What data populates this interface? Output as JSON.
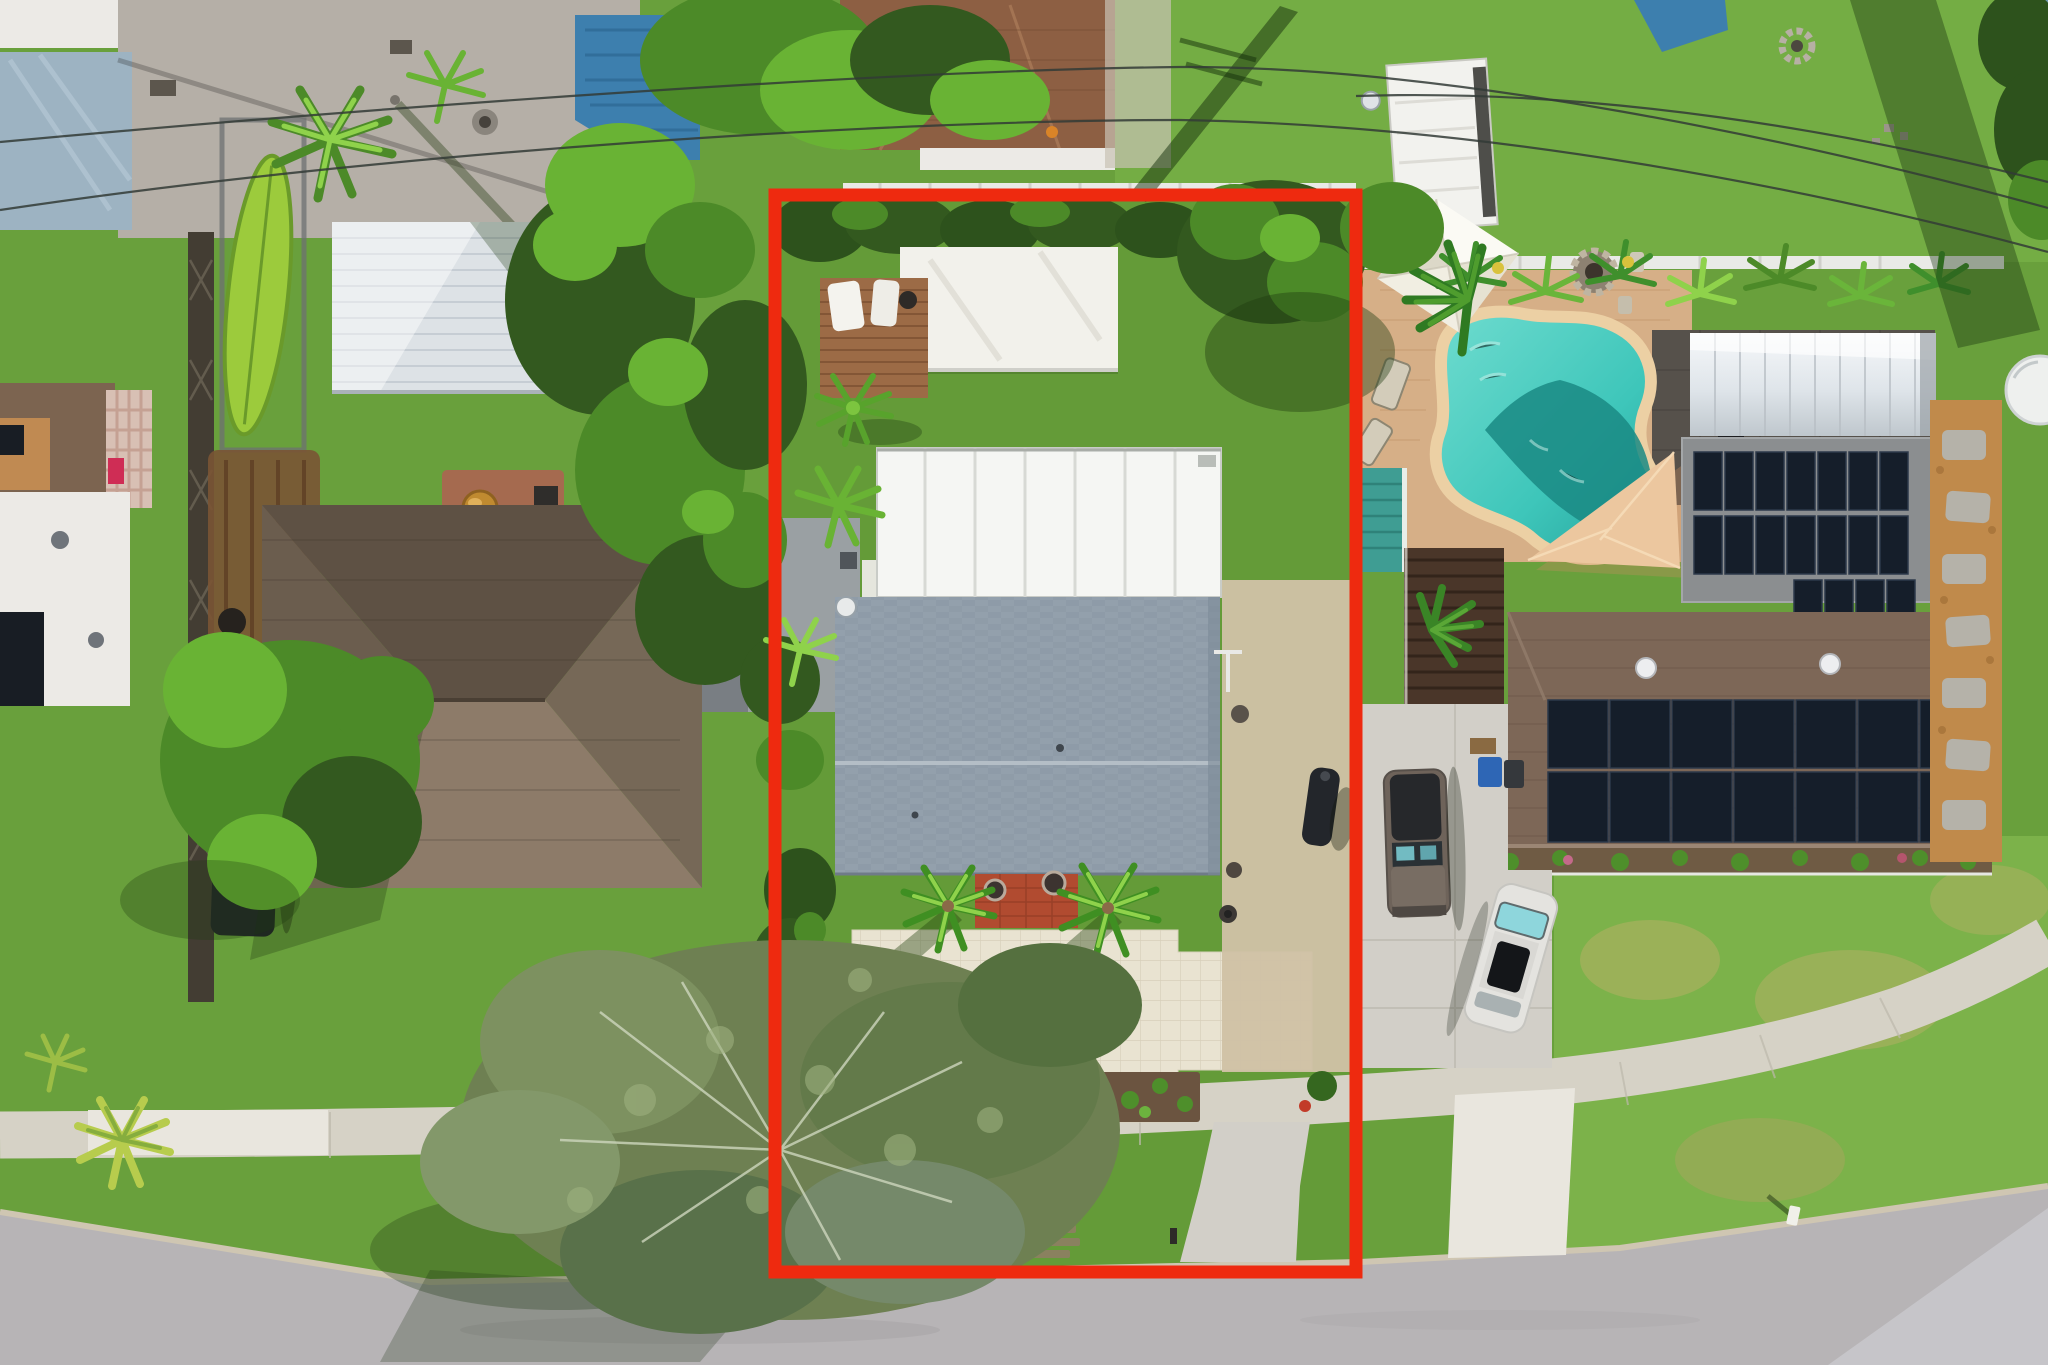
{
  "title": "Aerial drone photo of a residential neighborhood with one lot outlined in red",
  "canvas": {
    "width": 2048,
    "height": 1365
  },
  "annotation": {
    "label": "property-boundary-outline",
    "x": 775,
    "y": 195,
    "width": 581,
    "height": 1077,
    "stroke_width": 13,
    "color": "#ee2a0f"
  },
  "colors": {
    "grass_base": "#69a03c",
    "grass_lot": "#649b38",
    "grass_back": "#74ad44",
    "grass_front_r": "#7cb24a",
    "road": "#b7b4b6",
    "road_gutter": "#c6c5c9",
    "curb": "#cfc6b2",
    "sidewalk": "#d6d2c6",
    "concrete": "#d2cfc8",
    "concrete_bright": "#e9e6de",
    "paver_cream": "#e9e3d1",
    "paver_line": "#d8d0bb",
    "shed_white": "#f2f1eb",
    "carport_white": "#f5f6f3",
    "carport_seam": "#d7d9d4",
    "roof_gray": "#93a0ac",
    "roof_gray_line": "#8a97a3",
    "roof_ridge": "#b4bec6",
    "deck_brown": "#9c6b46",
    "porch_brick": "#b14b30",
    "gravel_tan": "#cfc2a5",
    "pool_deck_tan": "#d6af87",
    "patio_dark": "#56514b",
    "pool_water": "#3ec6ba",
    "pool_deep": "#1a8a84",
    "pool_coping": "#ecd0a4",
    "canopy_white": "#f7f5ee",
    "sail_peach": "#ecc79f",
    "solar_panel": "#151e2a",
    "solar_panel_edge": "#2c394a",
    "roof_brown_right": "#7d6757",
    "roof_brown_left_top": "#5e5144",
    "roof_brown_left_lit": "#8d7b69",
    "annex_gray": "#9aa0a3",
    "silver_metal": "#dde2e6",
    "blue_roof": "#3d7fae",
    "blue_slab": "#9db3c2",
    "teal_roof": "#3f9d93",
    "pergola_brown": "#4a3629",
    "mulch_orange": "#c08a4b",
    "mulch_bed": "#6b5440",
    "suv_taupe": "#6e635a",
    "car_white": "#e4e3df",
    "truck_black": "#212529",
    "kayak_green": "#9ccb3c",
    "trailer_rust": "#7a5434",
    "gold_bowl": "#c08a30",
    "fence_white": "#e9eae6",
    "tree_dark": "#33591f",
    "tree_mid": "#4c8a28",
    "tree_bright": "#69b334",
    "tree_gray": "#6e8052",
    "hedge_dark": "#2d521c",
    "shadow_green": "#15300c",
    "powerline": "#333b36",
    "white_structure": "#eceae6",
    "red_outline": "#ee2a0f"
  },
  "scene": {
    "subject_lot": {
      "label": "outlined listing property",
      "features": [
        "back lawn",
        "white flat-roof shed",
        "wood deck with two white loungers",
        "white metal carport",
        "gray shingle roof house with satellite dish",
        "red brick porch with two round planters",
        "cream paver courtyard driveway",
        "two royal palms",
        "two mulch planting beds",
        "tan gravel side yard",
        "wood stepping-stone path in verge",
        "concrete apron to street"
      ]
    },
    "left_property": {
      "features": [
        "brown hip-roof house",
        "gray flat annex",
        "silver corrugated shed",
        "green kayak on rack",
        "rusted utility trailer",
        "brick bbq with gold fire bowl",
        "black pickup truck",
        "large leafy tree",
        "huge gray-green tree over street corner",
        "lattice fence line"
      ]
    },
    "right_property": {
      "features": [
        "kidney-shaped pool",
        "white canopy tent",
        "stone fire pit",
        "tan paver pool deck",
        "tropical plant row on white fence",
        "peach shade sail",
        "flat roof with solar panels",
        "silver metal roof",
        "brown shingle roof with large solar array",
        "teal porch roof",
        "dark pergola",
        "concrete driveway with taupe SUV and white sedan",
        "orange mulch path with stepping stones",
        "white round tank",
        "lawn with dry patches",
        "small white mailbox"
      ]
    },
    "streetscape": {
      "features": [
        "asphalt street along bottom",
        "concrete sidewalk with corner curve",
        "grass verge",
        "utility power lines",
        "pole shadows",
        "white vinyl fences",
        "white camper",
        "blue tarp",
        "stone fire ring",
        "concrete patio with furniture"
      ]
    }
  }
}
